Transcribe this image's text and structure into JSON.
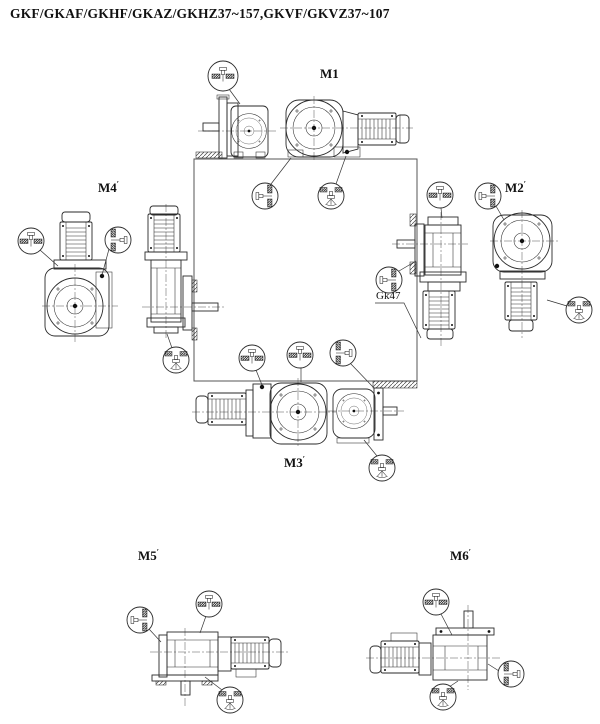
{
  "title": "GKF/GKAF/GKHF/GKAZ/GKHZ37~157,GKVF/GKVZ37~107",
  "colors": {
    "line": "#2a2a2a",
    "background": "#ffffff"
  },
  "mounting_positions": {
    "m1": {
      "label": "M1",
      "mark": ""
    },
    "m2": {
      "label": "M2",
      "mark": "′"
    },
    "m3": {
      "label": "M3",
      "mark": "′"
    },
    "m4": {
      "label": "M4",
      "mark": "′"
    },
    "m5": {
      "label": "M5",
      "mark": "′"
    },
    "m6": {
      "label": "M6",
      "mark": "′"
    }
  },
  "annotations": {
    "gk47": "Gk47"
  }
}
